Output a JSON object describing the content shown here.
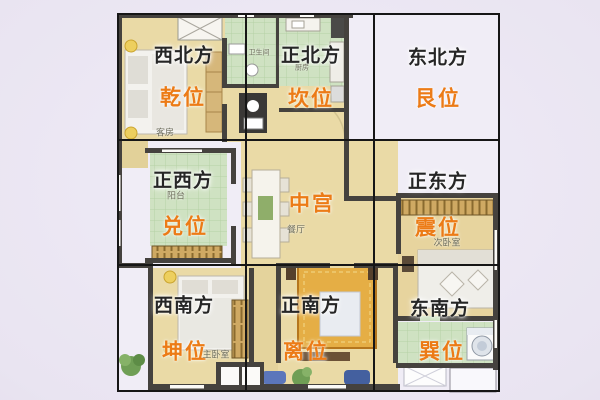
{
  "compass": {
    "cells": [
      {
        "id": "northwest",
        "direction": "西北方",
        "position": "乾位"
      },
      {
        "id": "north",
        "direction": "正北方",
        "position": "坎位"
      },
      {
        "id": "northeast",
        "direction": "东北方",
        "position": "艮位"
      },
      {
        "id": "west",
        "direction": "正西方",
        "position": "兑位"
      },
      {
        "id": "center",
        "direction": "",
        "position": "中宫"
      },
      {
        "id": "east",
        "direction": "正东方",
        "position": "震位"
      },
      {
        "id": "southwest",
        "direction": "西南方",
        "position": "坤位"
      },
      {
        "id": "south",
        "direction": "正南方",
        "position": "离位"
      },
      {
        "id": "southeast",
        "direction": "东南方",
        "position": "巽位"
      }
    ]
  },
  "rooms": {
    "guest_bedroom": "客房",
    "bathroom": "卫生间",
    "kitchen": "厨房",
    "west_balcony": "阳台",
    "dining_room": "餐厅",
    "second_bedroom": "次卧室",
    "master_bedroom": "主卧室"
  },
  "colors": {
    "background": "#e8e3f0",
    "accent_orange": "#ec7b16",
    "floor_tan": "#eadaa6",
    "tile_green": "#cfe2c2",
    "wall_dark": "#45423e",
    "grid_line": "#161616"
  }
}
